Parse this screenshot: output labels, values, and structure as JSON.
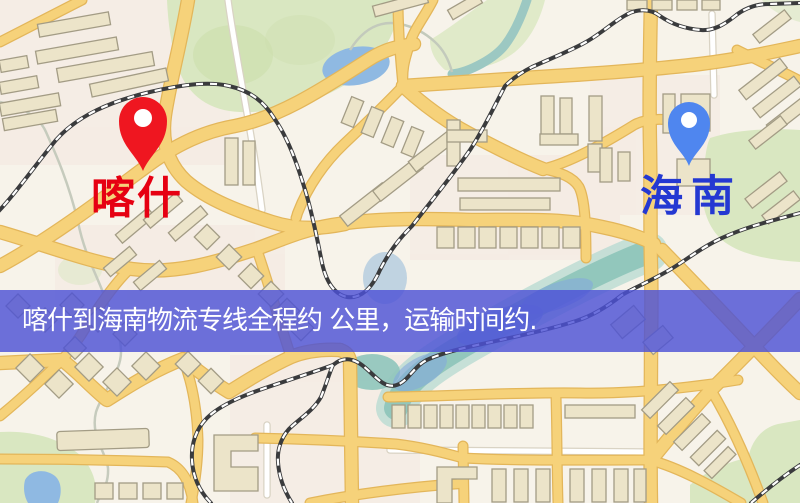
{
  "map": {
    "origin_marker": {
      "label": "喀什",
      "pin_color": "#ef1620",
      "label_color": "#e60012"
    },
    "destination_marker": {
      "label": "海南",
      "pin_color": "#4f86ef",
      "label_color": "#2438d2"
    },
    "banner": {
      "text": "喀什到海南物流专线全程约 公里，运输时间约.",
      "background_color": "#4d52d6",
      "text_color": "#ffffff"
    }
  },
  "palette": {
    "map_background": "#f7f3ea",
    "park_green": "#d9e7c1",
    "park_green_dark": "#ccdfad",
    "water_blue": "#8fb9e2",
    "river_teal": "#8fc5bb",
    "river_teal_light": "#b9dbd2",
    "road_yellow": "#f6d27a",
    "road_casing": "#e3b65a",
    "road_white": "#ffffff",
    "white_road_casing": "#d9d3c4",
    "railway_dark": "#3a3b3d",
    "building_fill": "#ece4c9",
    "building_stroke": "#a39c85",
    "urban_pink": "#f4e7df"
  }
}
